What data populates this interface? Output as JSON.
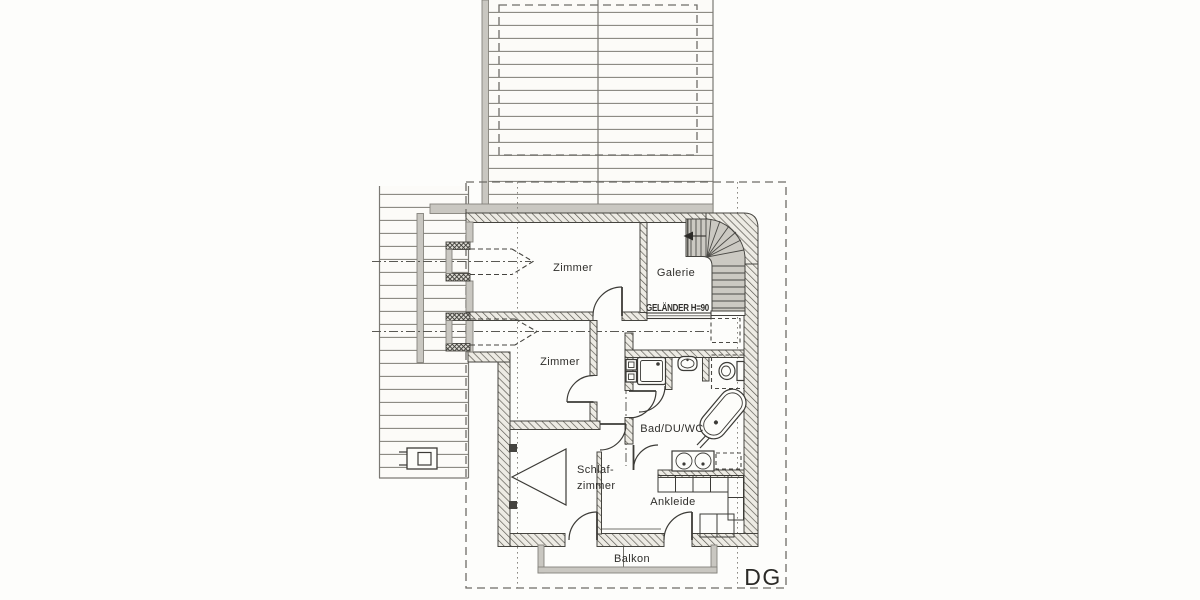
{
  "document": {
    "kind": "architectural floor plan scan",
    "floor_tag": "DG"
  },
  "colors": {
    "line": "#3c3b37",
    "roofline": "#7b7974",
    "grey": "#c9c7c1",
    "text": "#2f2e2b",
    "paper": "#fdfdfb"
  },
  "rooms": [
    {
      "id": "zimmer-1",
      "label": "Zimmer"
    },
    {
      "id": "galerie",
      "label": "Galerie"
    },
    {
      "id": "zimmer-2",
      "label": "Zimmer"
    },
    {
      "id": "bad",
      "label": "Bad/DU/WC"
    },
    {
      "id": "schlafzimmer",
      "label_line1": "Schlaf-",
      "label_line2": "zimmer"
    },
    {
      "id": "ankleide",
      "label": "Ankleide"
    },
    {
      "id": "balkon",
      "label": "Balkon"
    }
  ],
  "annotations": {
    "railing_note": "GELÄNDER H=90",
    "floor_tag": "DG"
  },
  "fixtures": [
    "stairs",
    "shower-icon",
    "washbasin-icon",
    "toilet-icon",
    "bathtub-icon",
    "double-washbasin-icon",
    "wardrobe",
    "chimney-icon",
    "roof-window-arrow",
    "balcony-railing",
    "stair-direction-arrow"
  ]
}
